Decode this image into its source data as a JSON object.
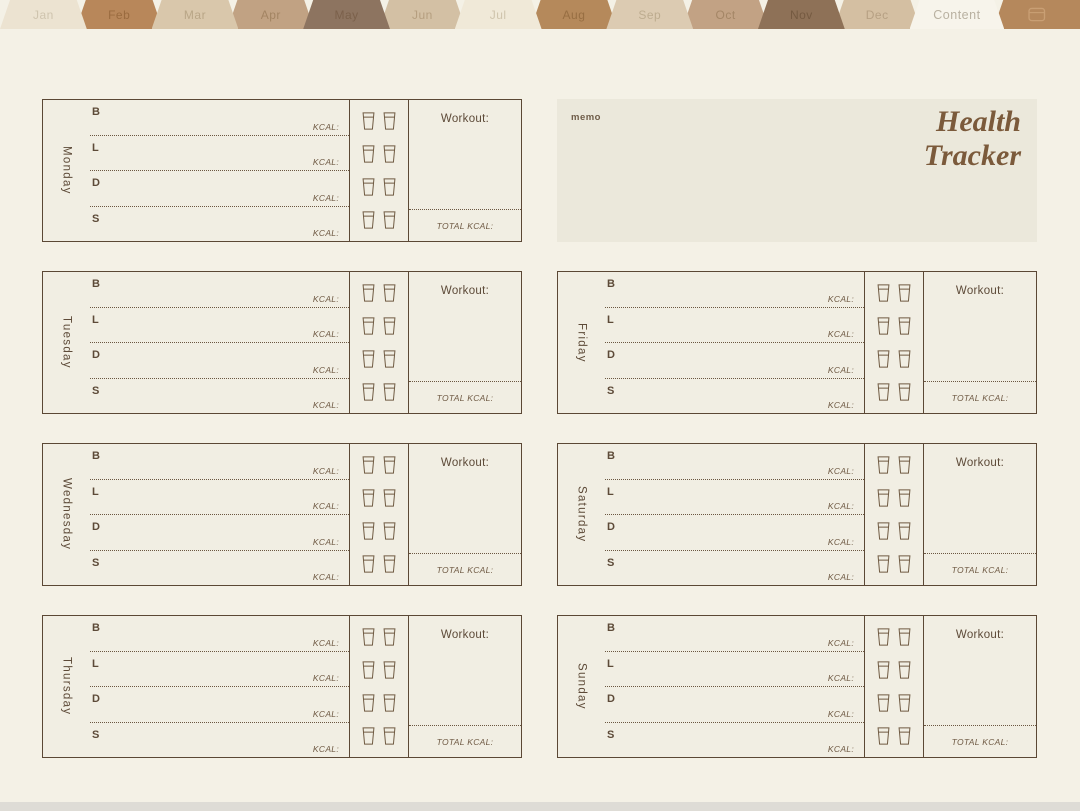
{
  "tabbar": {
    "tabs": [
      {
        "id": "jan",
        "label": "Jan",
        "bg": "#ece3d1",
        "fg": "#cfc4ae"
      },
      {
        "id": "feb",
        "label": "Feb",
        "bg": "#b8875a",
        "fg": "#9a6b3f"
      },
      {
        "id": "mar",
        "label": "Mar",
        "bg": "#d9c7ab",
        "fg": "#b9a687"
      },
      {
        "id": "apr",
        "label": "Apr",
        "bg": "#c1a283",
        "fg": "#a38463"
      },
      {
        "id": "may",
        "label": "May",
        "bg": "#8d7460",
        "fg": "#7b614b"
      },
      {
        "id": "jun",
        "label": "Jun",
        "bg": "#d3c0a4",
        "fg": "#b59e7f"
      },
      {
        "id": "jul",
        "label": "Jul",
        "bg": "#f0e9d8",
        "fg": "#cfc4ac"
      },
      {
        "id": "aug",
        "label": "Aug",
        "bg": "#b5895b",
        "fg": "#976e42"
      },
      {
        "id": "sep",
        "label": "Sep",
        "bg": "#dccbb2",
        "fg": "#bdac8f"
      },
      {
        "id": "oct",
        "label": "Oct",
        "bg": "#c2a284",
        "fg": "#a48666"
      },
      {
        "id": "nov",
        "label": "Nov",
        "bg": "#8e7157",
        "fg": "#755a41"
      },
      {
        "id": "dec",
        "label": "Dec",
        "bg": "#d4bfa2",
        "fg": "#b6a083"
      },
      {
        "id": "content",
        "label": "Content",
        "bg": "#f7f4eb",
        "fg": "#b9b1a1"
      },
      {
        "id": "bookmark",
        "label": "",
        "bg": "#b5885c",
        "fg": "#c99f74",
        "icon": "calendar-icon"
      }
    ]
  },
  "header": {
    "title_line1": "Health",
    "title_line2": "Tracker",
    "memo_label": "memo"
  },
  "tracker": {
    "days": [
      "Monday",
      "Tuesday",
      "Wednesday",
      "Thursday",
      "Friday",
      "Saturday",
      "Sunday"
    ],
    "meal_labels": [
      "B",
      "L",
      "D",
      "S"
    ],
    "kcal_label": "KCAL:",
    "workout_label": "Workout:",
    "total_kcal_label": "TOTAL KCAL:",
    "water_cups_per_day": 8
  },
  "colors": {
    "page_bg": "#f4f1e6",
    "card_bg": "#f1eee3",
    "card_border": "#5b4835",
    "memo_bg": "#ebe8db",
    "title_brown": "#7b5a3b",
    "ink_brown": "#5d4a38"
  }
}
